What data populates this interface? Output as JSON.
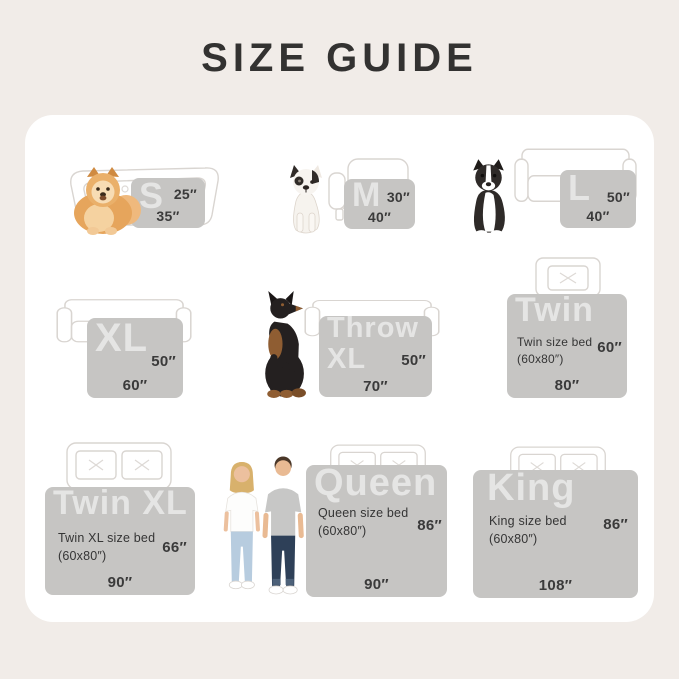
{
  "page": {
    "title": "SIZE GUIDE"
  },
  "colors": {
    "background": "#f1ece8",
    "card": "#ffffff",
    "blanket": "#c6c5c3",
    "blanket_label": "rgba(255,255,255,0.55)",
    "dimension_text": "#3a3a3a",
    "furniture_outline": "#d9d5d1"
  },
  "sizes": [
    {
      "label": "S",
      "side_dim": "25″",
      "bottom_dim": "35″",
      "scale_icon": "pomeranian-dog",
      "furniture_icon": "dog-bed"
    },
    {
      "label": "M",
      "side_dim": "30″",
      "bottom_dim": "40″",
      "scale_icon": "french-bulldog",
      "furniture_icon": "armchair"
    },
    {
      "label": "L",
      "side_dim": "50″",
      "bottom_dim": "40″",
      "scale_icon": "border-collie",
      "furniture_icon": "sofa"
    },
    {
      "label": "XL",
      "side_dim": "50″",
      "bottom_dim": "60″",
      "furniture_icon": "sofa"
    },
    {
      "label": "Throw XL",
      "side_dim": "50″",
      "bottom_dim": "70″",
      "scale_icon": "doberman-dog",
      "furniture_icon": "sofa"
    },
    {
      "label": "Twin",
      "sub_line1": "Twin size bed",
      "sub_line2": "(60x80″)",
      "side_dim": "60″",
      "bottom_dim": "80″",
      "furniture_icon": "bed-single-pillow"
    },
    {
      "label": "Twin XL",
      "sub_line1": "Twin XL size bed",
      "sub_line2": "(60x80″)",
      "side_dim": "66″",
      "bottom_dim": "90″",
      "furniture_icon": "bed-double-pillow"
    },
    {
      "label": "Queen",
      "sub_line1": "Queen size bed",
      "sub_line2": "(60x80″)",
      "side_dim": "86″",
      "bottom_dim": "90″",
      "scale_icon": "man-and-woman-couple",
      "furniture_icon": "bed-double-pillow"
    },
    {
      "label": "King",
      "sub_line1": "King size bed",
      "sub_line2": "(60x80″)",
      "side_dim": "86″",
      "bottom_dim": "108″",
      "furniture_icon": "bed-double-pillow"
    }
  ]
}
